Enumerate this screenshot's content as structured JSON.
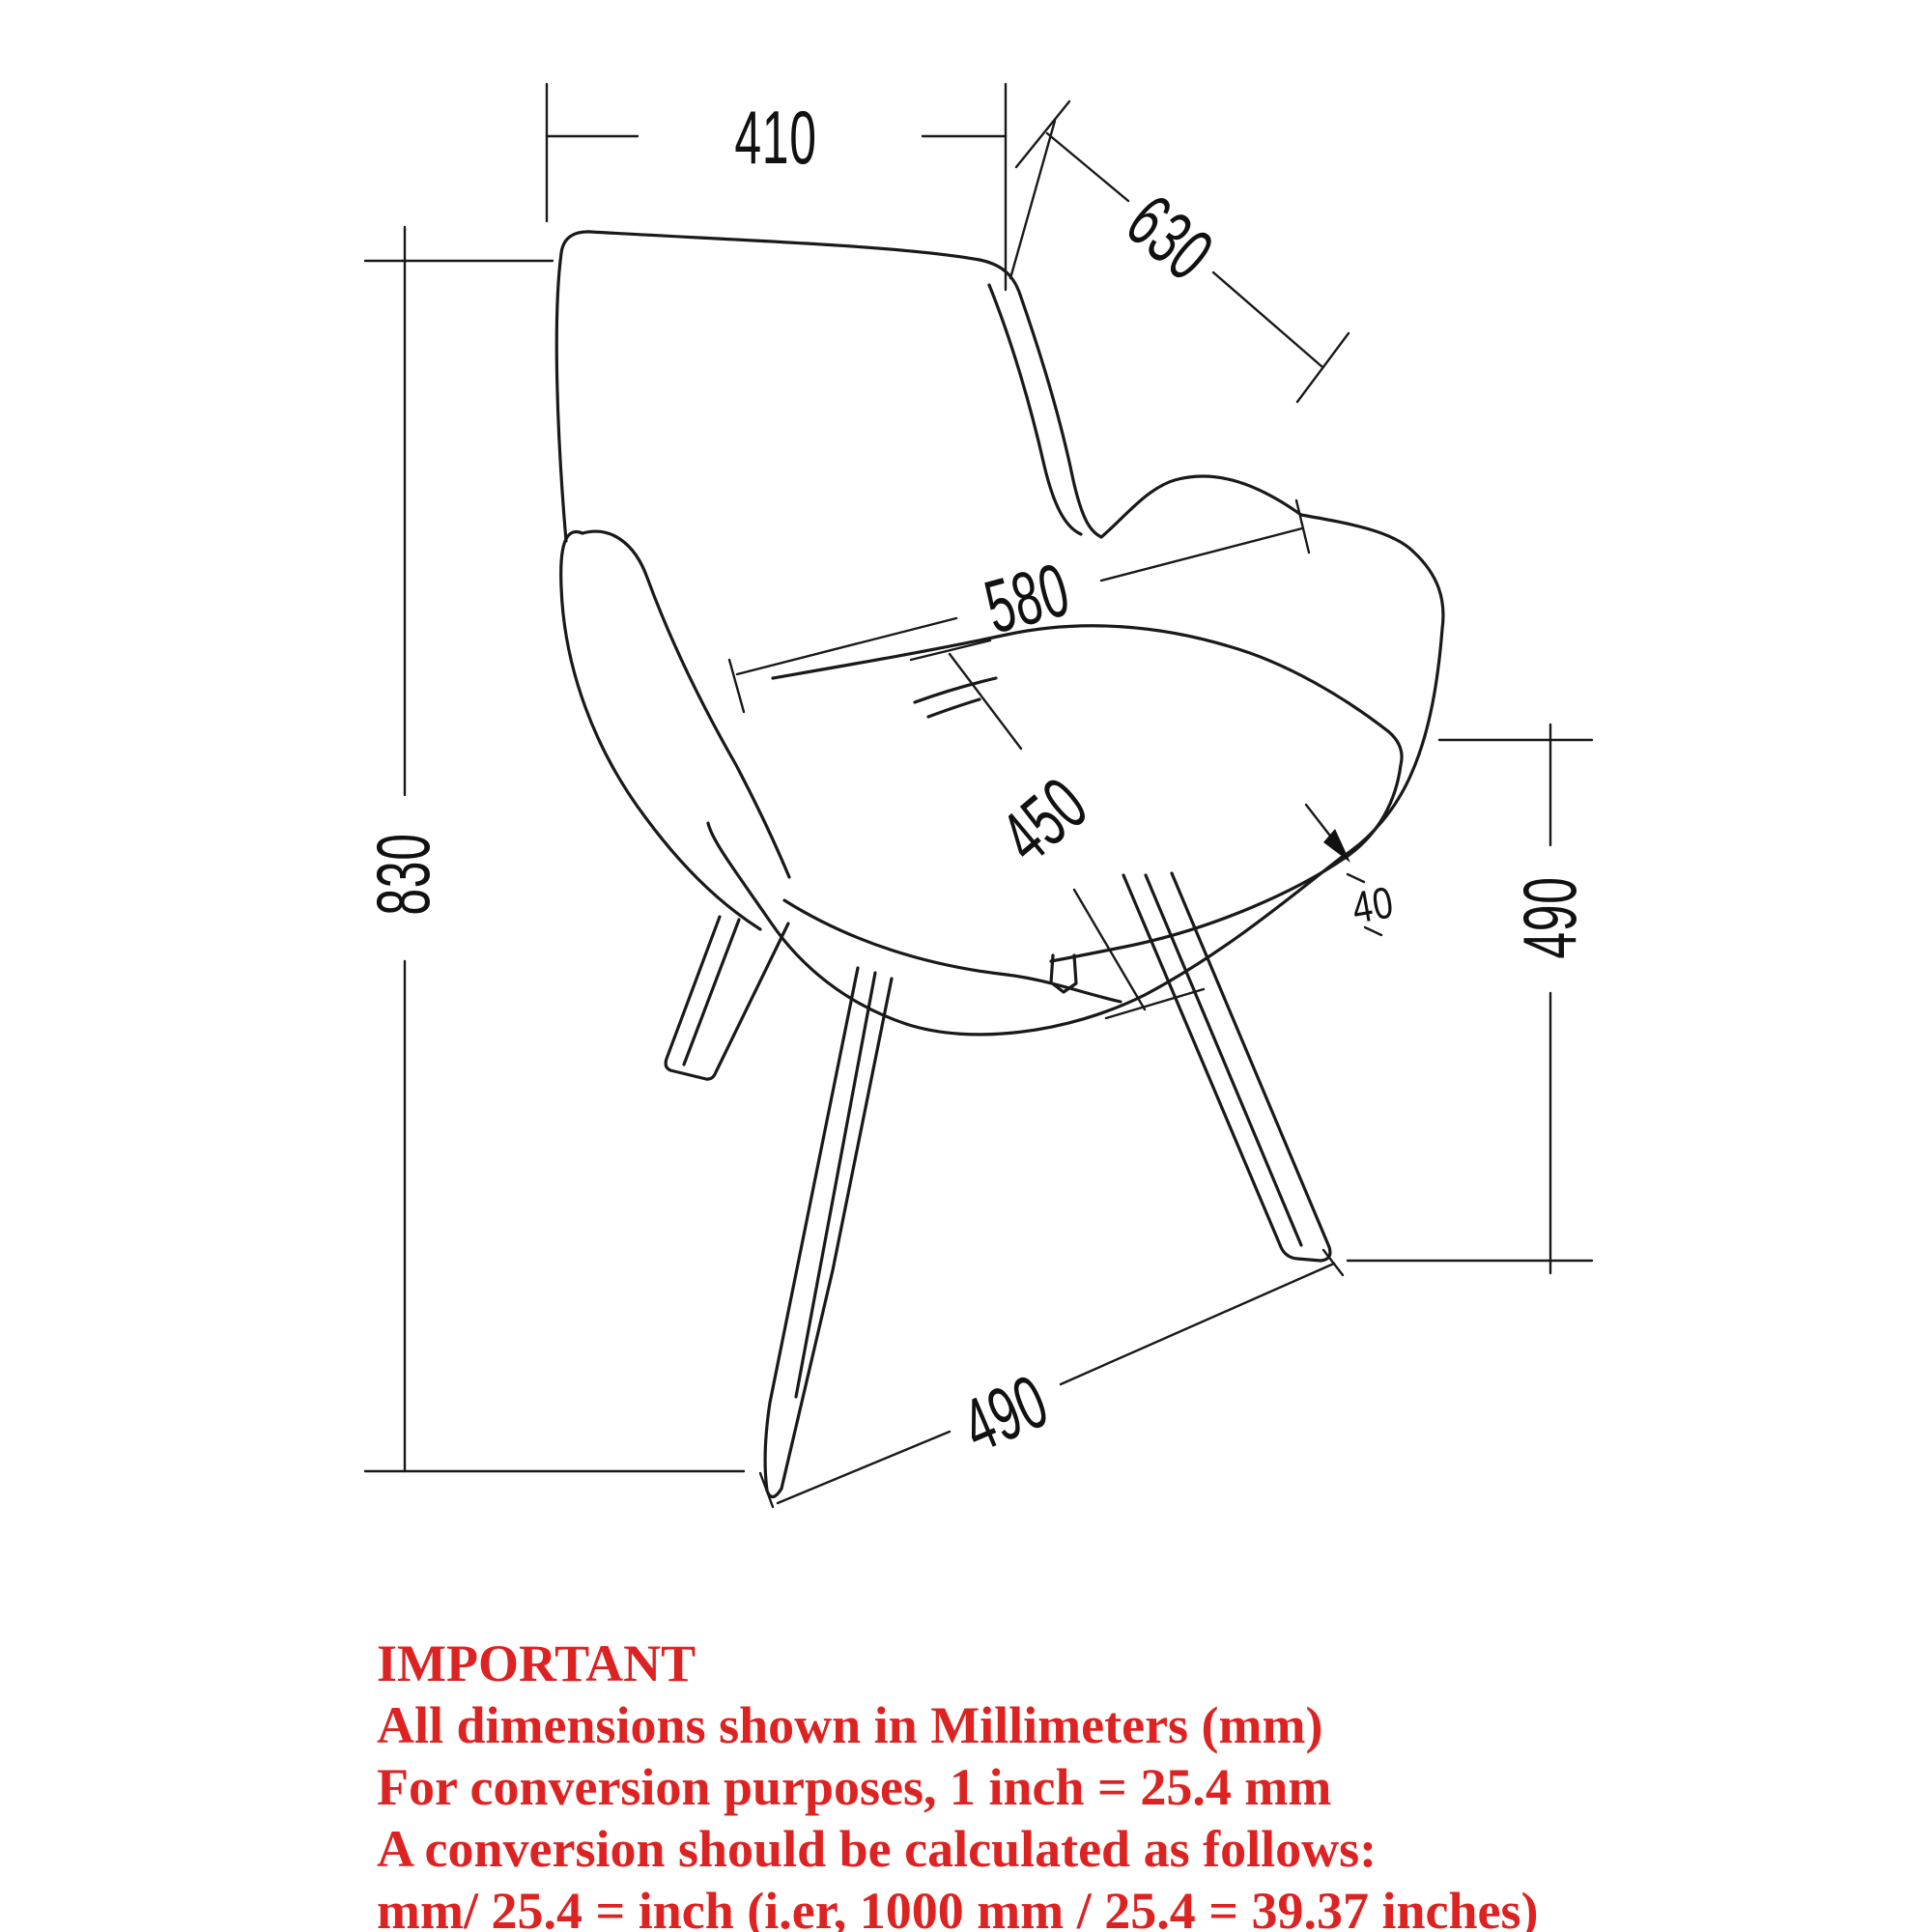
{
  "drawing": {
    "type": "furniture-dimension-diagram",
    "subject": "accent armchair with splayed metal legs",
    "units": "mm",
    "dimensions": {
      "back_width": "410",
      "back_slant_height": "630",
      "seat_width": "580",
      "seat_depth": "450",
      "overall_height": "830",
      "seat_height_right": "490",
      "seat_shell_thickness": "40",
      "front_leg_span": "490"
    }
  },
  "notice": {
    "lines": [
      "IMPORTANT",
      "All dimensions shown in Millimeters (mm)",
      "For conversion purposes, 1 inch = 25.4 mm",
      "A conversion should be calculated as follows:",
      "mm/ 25.4 = inch (i.er, 1000 mm / 25.4 = 39.37 inches)"
    ]
  },
  "colors": {
    "line": "#191919",
    "notice_red": "#dd2222",
    "background": "#ffffff"
  }
}
